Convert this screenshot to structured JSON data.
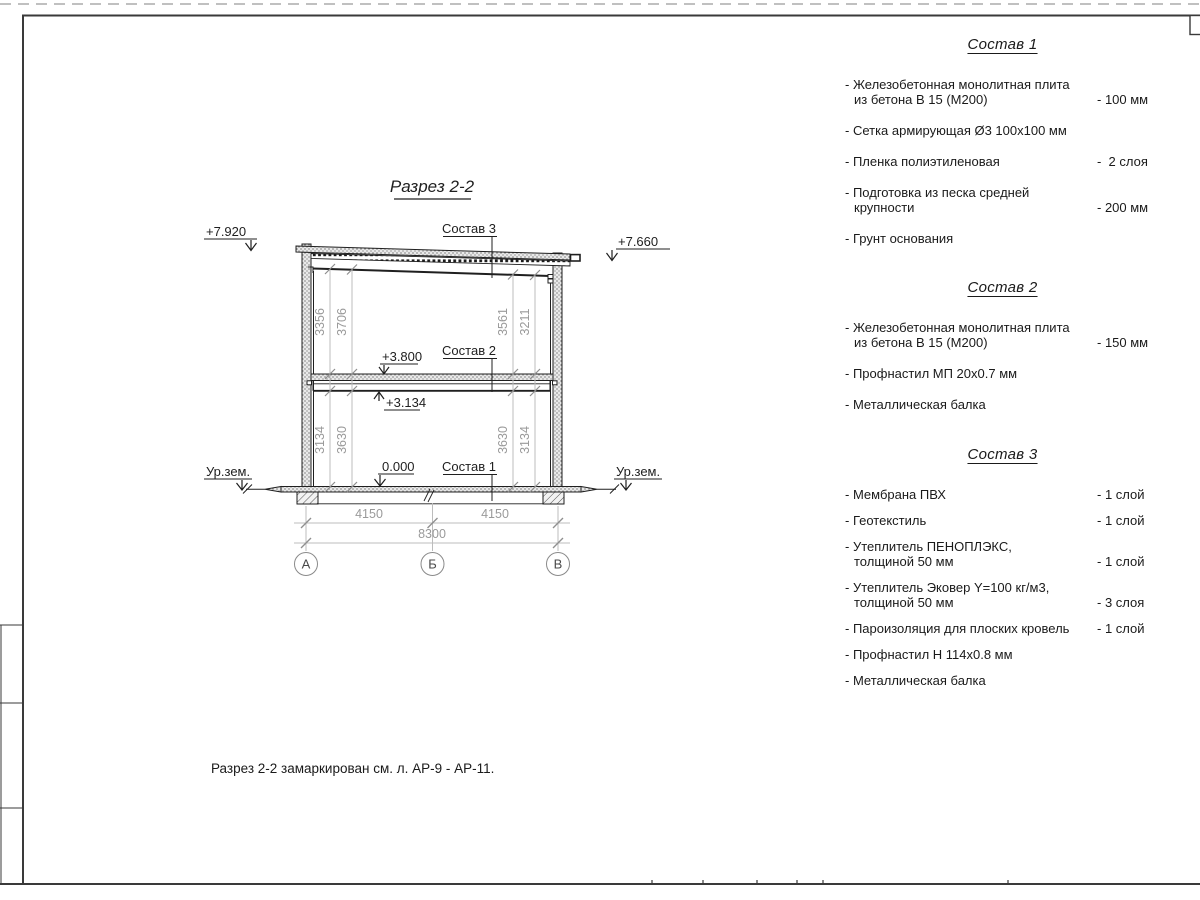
{
  "drawing": {
    "title": "Разрез 2-2",
    "elevation_marks": {
      "roof_left": "+7.920",
      "roof_right": "+7.660",
      "floor_slab": "+3.800",
      "beam_bottom": "+3.134",
      "ground_floor": "0.000",
      "ground_level_left": "Ур.зем.",
      "ground_level_right": "Ур.зем."
    },
    "callouts": {
      "sostav3": "Состав 3",
      "sostav2": "Состав 2",
      "sostav1": "Состав 1"
    },
    "dims": {
      "v_left_upper_inner": "3356",
      "v_left_upper_outer": "3706",
      "v_right_upper_inner": "3561",
      "v_right_upper_outer": "3211",
      "v_left_lower_inner": "3134",
      "v_left_lower_outer": "3630",
      "v_right_lower_inner": "3630",
      "v_right_lower_outer": "3134",
      "span_left": "4150",
      "span_right": "4150",
      "total": "8300"
    },
    "axes": {
      "a": "А",
      "b": "Б",
      "v": "В"
    }
  },
  "compositions": [
    {
      "heading": "Состав 1",
      "items": [
        {
          "line1": "- Железобетонная  монолитная плита",
          "line2": "из бетона В 15 (М200)",
          "value": "- 100 мм"
        },
        {
          "line1": "- Сетка армирующая Ø3 100х100 мм",
          "line2": "",
          "value": ""
        },
        {
          "line1": "- Пленка полиэтиленовая",
          "line2": "",
          "value": "-  2 слоя"
        },
        {
          "line1": "- Подготовка из песка средней",
          "line2": "крупности",
          "value": "- 200 мм"
        },
        {
          "line1": "- Грунт основания",
          "line2": "",
          "value": ""
        }
      ]
    },
    {
      "heading": "Состав 2",
      "items": [
        {
          "line1": "- Железобетонная  монолитная плита",
          "line2": "из бетона В 15 (М200)",
          "value": "- 150 мм"
        },
        {
          "line1": "- Профнастил МП 20х0.7 мм",
          "line2": "",
          "value": ""
        },
        {
          "line1": "- Металлическая балка",
          "line2": "",
          "value": ""
        }
      ]
    },
    {
      "heading": "Состав 3",
      "items": [
        {
          "line1": "- Мембрана ПВХ",
          "line2": "",
          "value": "- 1 слой"
        },
        {
          "line1": "- Геотекстиль",
          "line2": "",
          "value": "- 1 слой"
        },
        {
          "line1": "- Утеплитель ПЕНОПЛЭКС,",
          "line2": "толщиной 50 мм",
          "value": "- 1 слой"
        },
        {
          "line1": "- Утеплитель Эковер Y=100 кг/м3,",
          "line2": "толщиной 50 мм",
          "value": "- 3 слоя"
        },
        {
          "line1": "- Пароизоляция для плоских кровель",
          "line2": "",
          "value": "- 1 слой"
        },
        {
          "line1": "- Профнастил Н 114х0.8 мм",
          "line2": "",
          "value": ""
        },
        {
          "line1": "- Металлическая балка",
          "line2": "",
          "value": ""
        }
      ]
    }
  ],
  "note": "Разрез 2-2 замаркирован см. л. АР-9 - АР-11."
}
